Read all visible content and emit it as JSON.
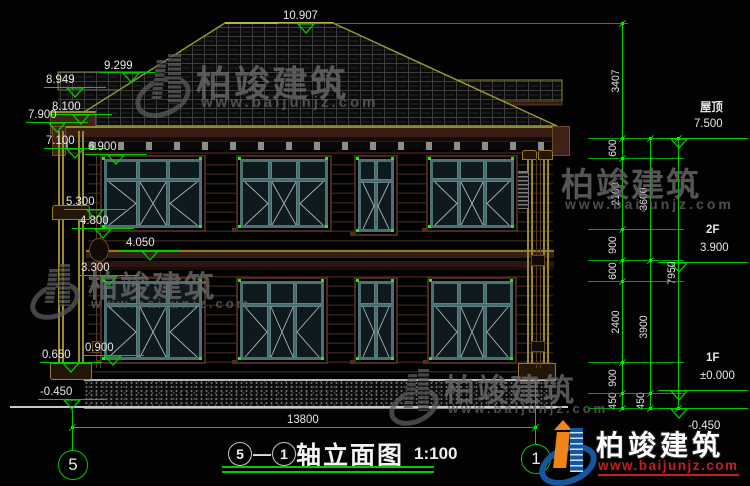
{
  "title": {
    "axis_from": "5",
    "separator": "—",
    "axis_to": "1",
    "name": "轴立面图",
    "scale": "1:100"
  },
  "axis_bubbles": {
    "left": "5",
    "right": "1"
  },
  "elevations_left": [
    "10.907",
    "9.299",
    "8.949",
    "8.100",
    "7.900",
    "7.100",
    "6.900",
    "5.300",
    "4.800",
    "4.050",
    "3.300",
    "0.900",
    "0.650",
    "-0.450"
  ],
  "elevations_right": [
    {
      "label": "屋顶",
      "value": "7.500"
    },
    {
      "label": "2F",
      "value": "3.900"
    },
    {
      "label": "1F",
      "value": "±0.000"
    },
    {
      "label": "",
      "value": "-0.450"
    }
  ],
  "dimensions": {
    "chain_inner": [
      "3407",
      "600",
      "2100",
      "900",
      "600",
      "2400",
      "900",
      "450"
    ],
    "chain_middle": [
      "3600",
      "3900",
      "450"
    ],
    "chain_outer": [
      "7950"
    ],
    "bottom_width": "13800"
  },
  "watermark": {
    "brand": "柏竣建筑",
    "url": "www.baijunjz.com"
  },
  "logo": {
    "brand": "柏竣建筑",
    "url": "www.baijunjz.com"
  }
}
